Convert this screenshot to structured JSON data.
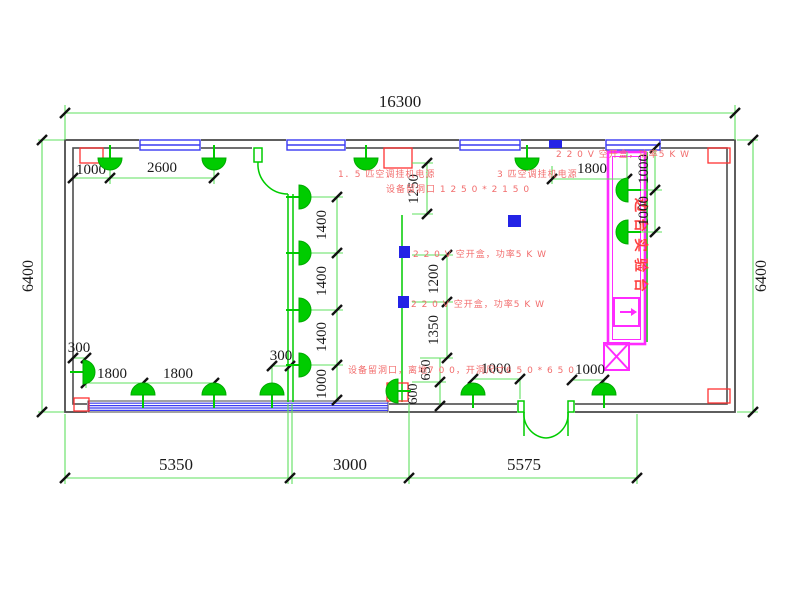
{
  "annotations": {
    "ac_power_15": "1．5 匹空调挂机电源",
    "ac_power_3": "3 匹空调挂机电源",
    "opening_top": "设备留洞口 1 2 5 0 * 2 1 5 0",
    "breaker_top_right": "2 2 0 V 空开盒，功率5 K W",
    "breaker_mid_1": "2 2 0 V 空开盒，功率5 K W",
    "breaker_mid_2": "2 2 0 V 空开盒，功率5 K W",
    "opening_bottom": "设备留洞口，离地7 0 0，开洞尺寸6 5 0 * 6 5 0",
    "bench_label": "边台实验台"
  },
  "dimensions": {
    "top_overall": "16300",
    "left_side": "6400",
    "right_side": "6400",
    "bottom": [
      "5350",
      "3000",
      "5575"
    ],
    "top_left": [
      "1000",
      "2600"
    ],
    "top_right": "1800",
    "partition_col": [
      "1400",
      "1400",
      "1400",
      "1000"
    ],
    "center_col": [
      "1250",
      "1200",
      "1350",
      "650",
      "600"
    ],
    "bench_col": [
      "1000",
      "1000"
    ],
    "bottom_left": [
      "300",
      "1800",
      "1800",
      "300"
    ],
    "bottom_mid": "1000",
    "bottom_right": "1000"
  },
  "colors": {
    "fixture_green": "#00cc00",
    "dim_line_green": "#5fe05f",
    "window_blue": "#3a3af2",
    "annotation_red": "#f26d6d",
    "bench_magenta": "#ff2bff",
    "wall_gray": "#4d4d4d"
  }
}
